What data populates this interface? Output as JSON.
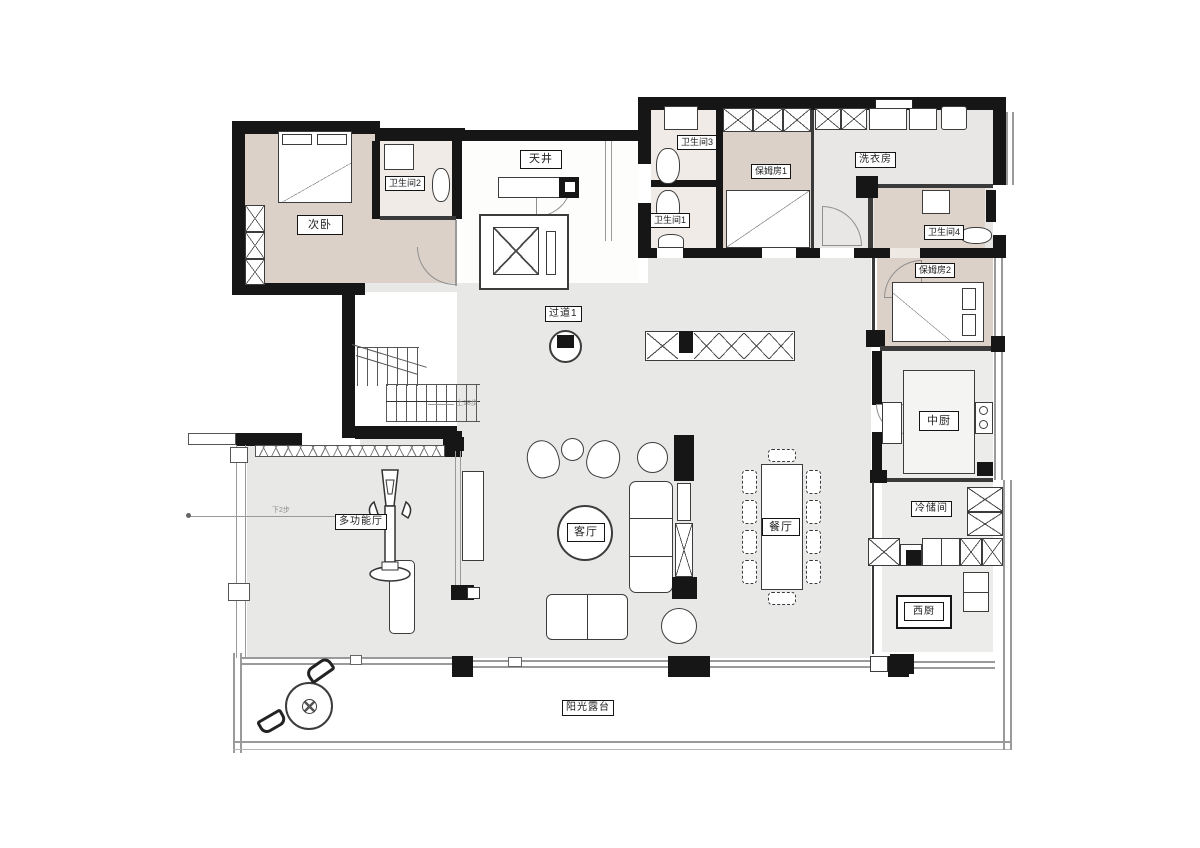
{
  "figure": "residential-floor-plan",
  "colors": {
    "wall": "#161616",
    "floor_gray": "#e8e8e7",
    "floor_beige": "#dcd1c8",
    "floor_bath": "#f0ebe7",
    "line_gray": "#9a9a9a"
  },
  "rooms": {
    "bedroom": "次卧",
    "bath2": "卫生间2",
    "atrium": "天井",
    "bath3": "卫生间3",
    "nanny1": "保姆房1",
    "laundry": "洗衣房",
    "bath1": "卫生间1",
    "bath4": "卫生间4",
    "nanny2": "保姆房2",
    "corridor1": "过道1",
    "cn_kitchen": "中厨",
    "multi_hall": "多功能厅",
    "living": "客厅",
    "dining": "餐厅",
    "cold_storage": "冷储间",
    "west_kitchen": "西厨",
    "terrace": "阳光露台"
  },
  "annotations": {
    "stair_note": "上18步",
    "step_note": "下2步"
  }
}
